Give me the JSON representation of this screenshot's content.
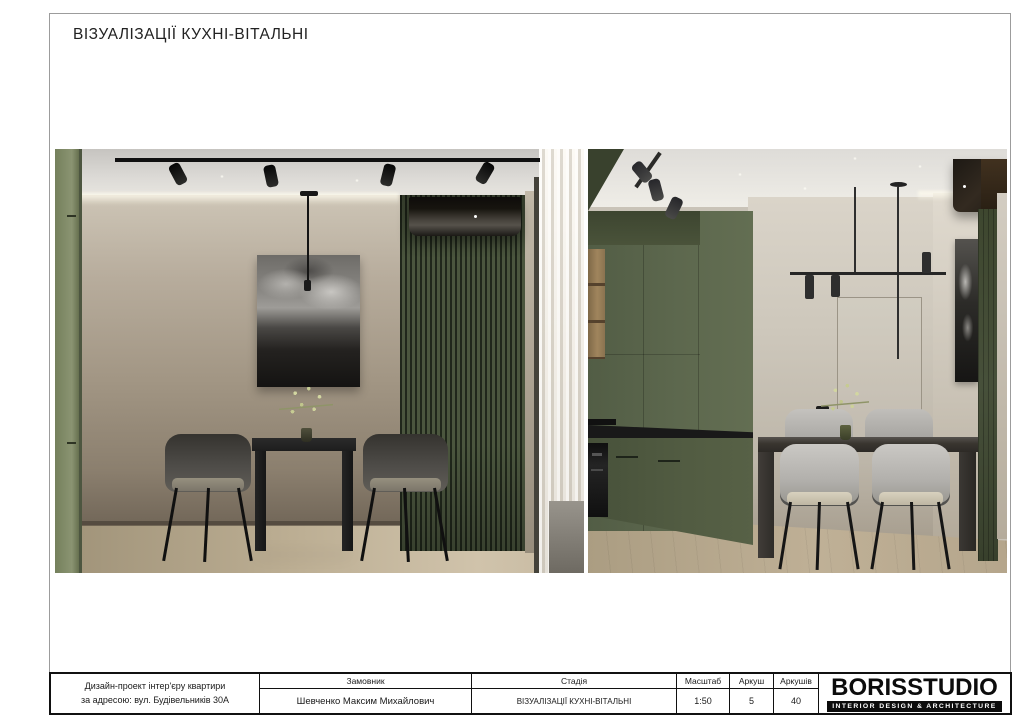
{
  "page": {
    "title": "ВІЗУАЛІЗАЦІЇ КУХНІ-ВІТАЛЬНІ"
  },
  "title_block": {
    "project_description": [
      "Дизайн-проект інтер'єру квартири",
      "за адресою: вул. Будівельників 30А"
    ],
    "fields": [
      {
        "label": "Замовник",
        "value": "Шевченко Максим Михайлович"
      },
      {
        "label": "Стадія",
        "value": "ВІЗУАЛІЗАЦІЇ КУХНІ-ВІТАЛЬНІ"
      },
      {
        "label": "Масштаб",
        "value": "1:50"
      },
      {
        "label": "Аркуш",
        "value": "5"
      },
      {
        "label": "Аркушів",
        "value": "40"
      }
    ],
    "logo": {
      "brand": "BORISSTUDIO",
      "tagline": "INTERIOR DESIGN & ARCHITECTURE"
    }
  },
  "palette": {
    "cabinetGreen": "#5d684e",
    "slatGreen": "#4b563e",
    "panelGreen": "#47503a",
    "wallBeige": "#ab9f8f",
    "wallLight": "#c9c3b8",
    "floorWood": "#b8ab90",
    "inkBlack": "#232323",
    "chairLight": "#b5b3af",
    "frameGray": "#9c9c9c"
  }
}
